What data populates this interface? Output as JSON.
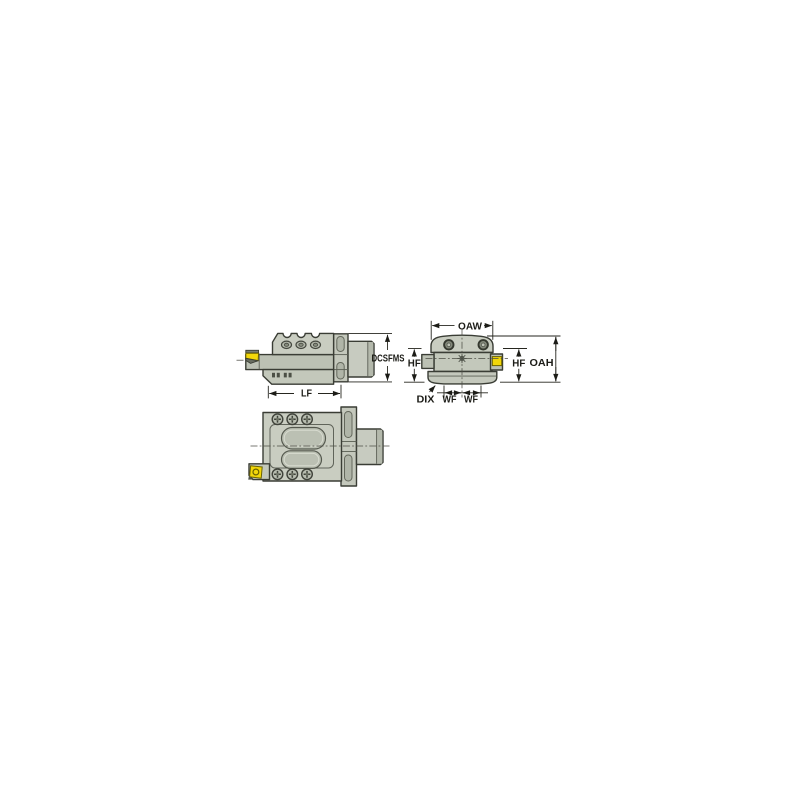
{
  "drawing": {
    "labels": {
      "dcsfms": "DCSFMS",
      "lf": "LF",
      "oaw": "OAW",
      "oah": "OAH",
      "hf_left": "HF",
      "hf_right": "HF",
      "wf_left": "WF",
      "wf_right": "WF",
      "dix": "DIX"
    },
    "colors": {
      "background": "#ffffff",
      "body_light": "#c9cdc1",
      "body_mid": "#c3c8bb",
      "body_shade": "#b4b9ac",
      "outline": "#3a3d35",
      "insert_yellow": "#f2d70a",
      "dimension_ink": "#1c1c17"
    }
  }
}
